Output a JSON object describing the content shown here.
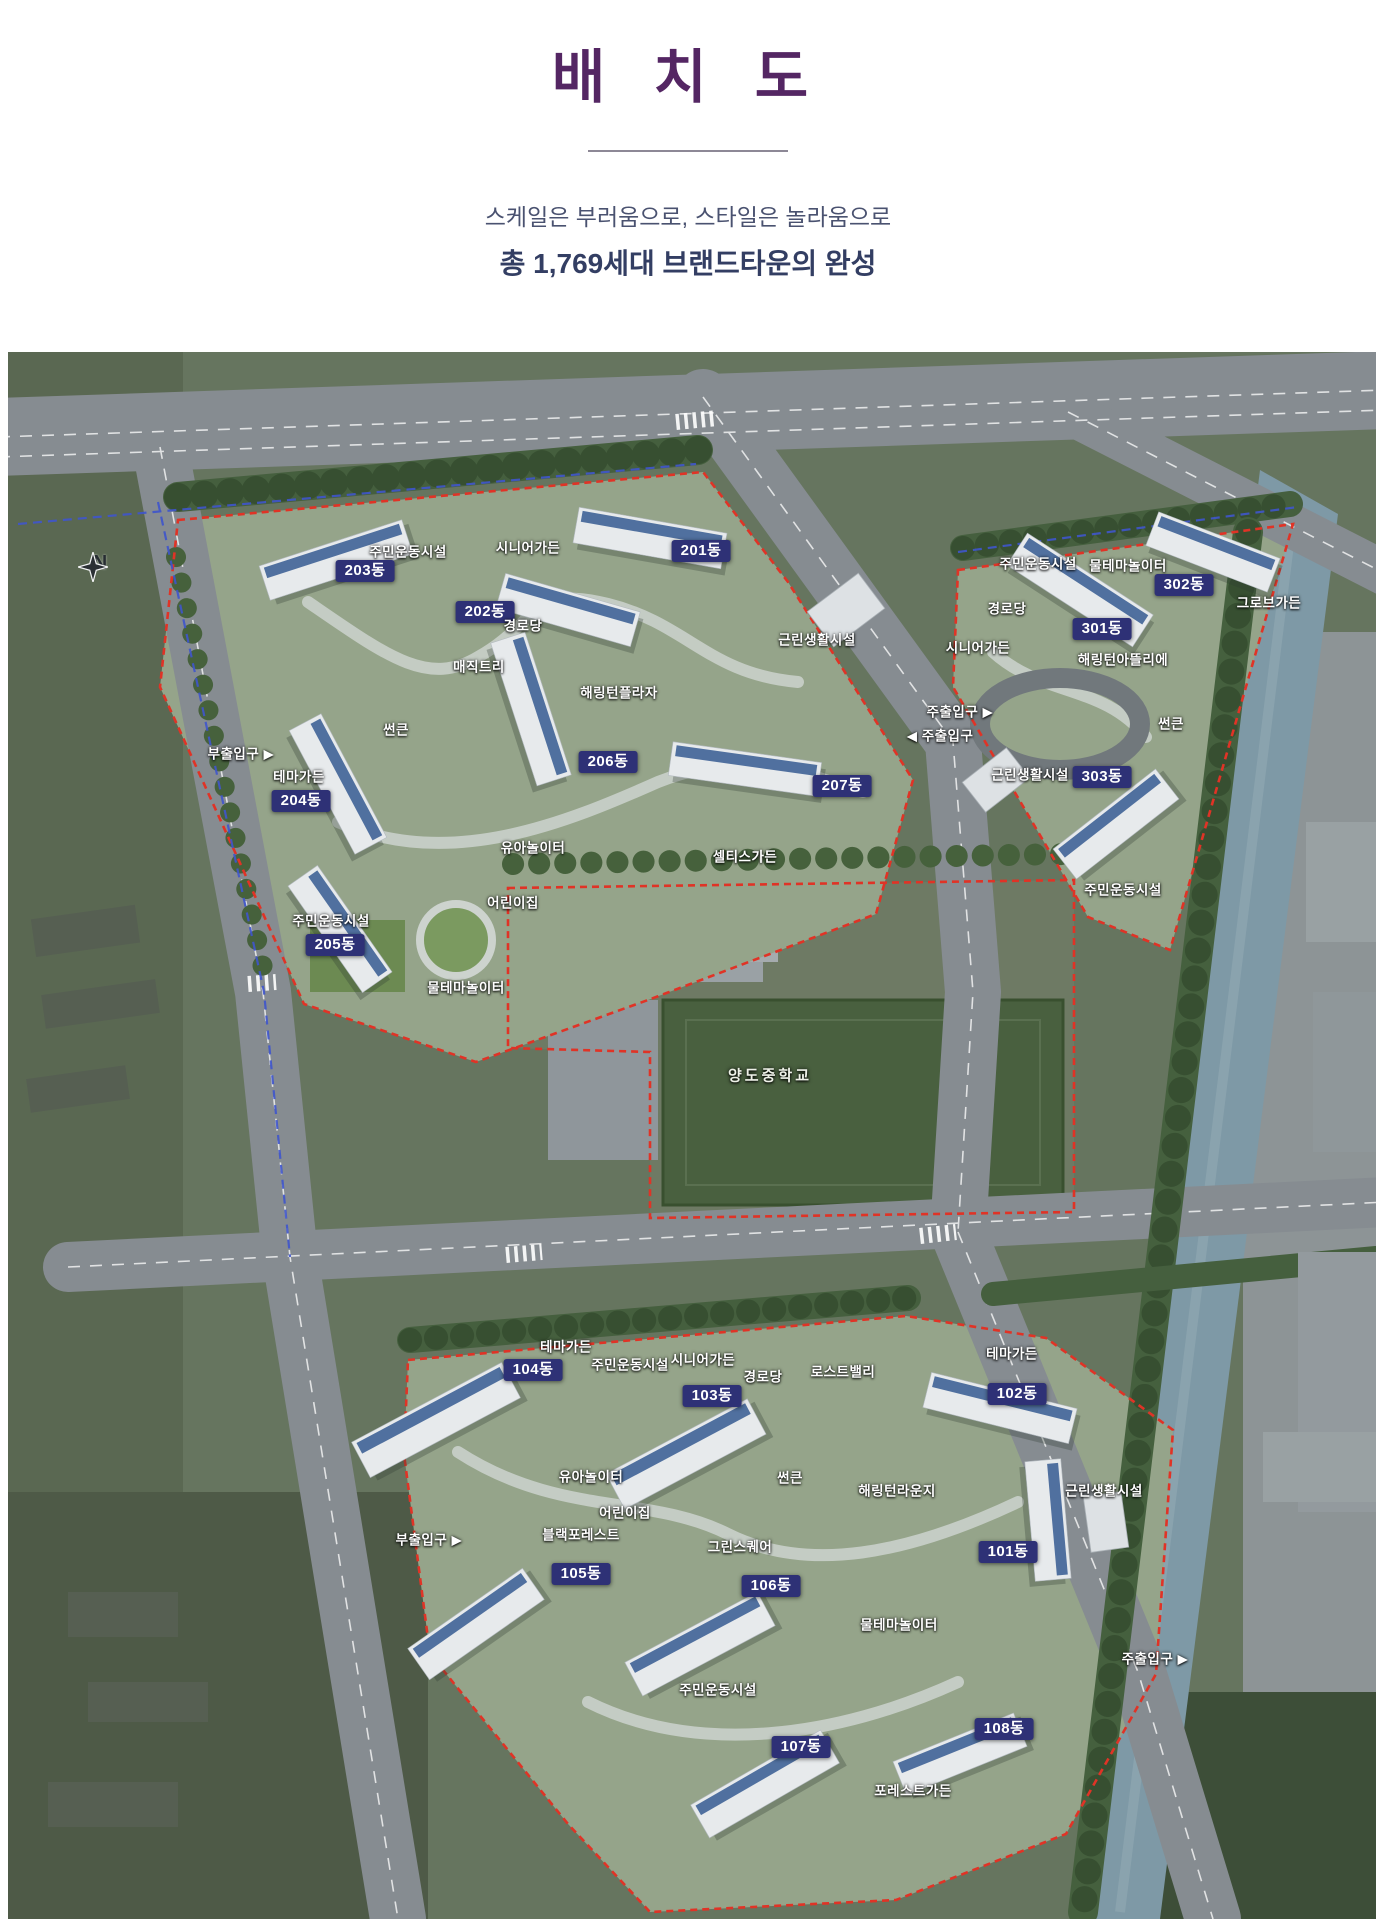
{
  "page": {
    "title": "배 치 도",
    "subtitle1": "스케일은 부러움으로, 스타일은 놀라움으로",
    "subtitle2": "총 1,769세대 브랜드타운의 완성"
  },
  "colors": {
    "title_purple": "#542663",
    "subtitle_navy": "#333e63",
    "dong_badge_navy": "#2e3176",
    "site_boundary_red": "#e03326",
    "road_boundary_blue": "#3f55cc"
  },
  "map": {
    "compass": "N",
    "labels": [
      {
        "text": "주민운동시설",
        "x": 400,
        "y": 200,
        "type": "place"
      },
      {
        "text": "203동",
        "x": 357,
        "y": 219,
        "type": "dong"
      },
      {
        "text": "시니어가든",
        "x": 520,
        "y": 196,
        "type": "place"
      },
      {
        "text": "201동",
        "x": 693,
        "y": 199,
        "type": "dong"
      },
      {
        "text": "202동",
        "x": 477,
        "y": 260,
        "type": "dong"
      },
      {
        "text": "경로당",
        "x": 515,
        "y": 274,
        "type": "place"
      },
      {
        "text": "매직트리",
        "x": 471,
        "y": 315,
        "type": "place"
      },
      {
        "text": "해링턴플라자",
        "x": 611,
        "y": 341,
        "type": "place"
      },
      {
        "text": "근린생활시설",
        "x": 809,
        "y": 288,
        "type": "place"
      },
      {
        "text": "썬큰",
        "x": 388,
        "y": 378,
        "type": "place"
      },
      {
        "text": "부출입구 ▶",
        "x": 233,
        "y": 402,
        "type": "entrance"
      },
      {
        "text": "테마가든",
        "x": 291,
        "y": 425,
        "type": "place"
      },
      {
        "text": "204동",
        "x": 293,
        "y": 449,
        "type": "dong"
      },
      {
        "text": "206동",
        "x": 600,
        "y": 410,
        "type": "dong"
      },
      {
        "text": "207동",
        "x": 834,
        "y": 434,
        "type": "dong"
      },
      {
        "text": "유아놀이터",
        "x": 525,
        "y": 496,
        "type": "place"
      },
      {
        "text": "셀티스가든",
        "x": 737,
        "y": 505,
        "type": "place"
      },
      {
        "text": "어린이집",
        "x": 505,
        "y": 551,
        "type": "place"
      },
      {
        "text": "주민운동시설",
        "x": 323,
        "y": 569,
        "type": "place"
      },
      {
        "text": "205동",
        "x": 327,
        "y": 593,
        "type": "dong"
      },
      {
        "text": "물테마놀이터",
        "x": 458,
        "y": 636,
        "type": "place"
      },
      {
        "text": "주민운동시설",
        "x": 1030,
        "y": 212,
        "type": "place"
      },
      {
        "text": "물테마놀이터",
        "x": 1120,
        "y": 214,
        "type": "place"
      },
      {
        "text": "302동",
        "x": 1176,
        "y": 233,
        "type": "dong"
      },
      {
        "text": "그로브가든",
        "x": 1261,
        "y": 251,
        "type": "place"
      },
      {
        "text": "경로당",
        "x": 999,
        "y": 257,
        "type": "place"
      },
      {
        "text": "301동",
        "x": 1094,
        "y": 277,
        "type": "dong"
      },
      {
        "text": "시니어가든",
        "x": 970,
        "y": 296,
        "type": "place"
      },
      {
        "text": "해링턴아뜰리에",
        "x": 1115,
        "y": 308,
        "type": "place"
      },
      {
        "text": "주출입구 ▶",
        "x": 952,
        "y": 360,
        "type": "entrance"
      },
      {
        "text": "◀ 주출입구",
        "x": 932,
        "y": 384,
        "type": "entrance"
      },
      {
        "text": "썬큰",
        "x": 1163,
        "y": 372,
        "type": "place"
      },
      {
        "text": "근린생활시설",
        "x": 1022,
        "y": 423,
        "type": "place"
      },
      {
        "text": "303동",
        "x": 1094,
        "y": 425,
        "type": "dong"
      },
      {
        "text": "주민운동시설",
        "x": 1115,
        "y": 538,
        "type": "place"
      },
      {
        "text": "양도중학교",
        "x": 762,
        "y": 724,
        "type": "school"
      },
      {
        "text": "테마가든",
        "x": 558,
        "y": 995,
        "type": "place"
      },
      {
        "text": "104동",
        "x": 525,
        "y": 1018,
        "type": "dong"
      },
      {
        "text": "주민운동시설",
        "x": 622,
        "y": 1013,
        "type": "place"
      },
      {
        "text": "시니어가든",
        "x": 695,
        "y": 1008,
        "type": "place"
      },
      {
        "text": "경로당",
        "x": 755,
        "y": 1025,
        "type": "place"
      },
      {
        "text": "로스트밸리",
        "x": 835,
        "y": 1020,
        "type": "place"
      },
      {
        "text": "103동",
        "x": 704,
        "y": 1044,
        "type": "dong"
      },
      {
        "text": "테마가든",
        "x": 1004,
        "y": 1002,
        "type": "place"
      },
      {
        "text": "102동",
        "x": 1009,
        "y": 1042,
        "type": "dong"
      },
      {
        "text": "유아놀이터",
        "x": 583,
        "y": 1125,
        "type": "place"
      },
      {
        "text": "썬큰",
        "x": 782,
        "y": 1126,
        "type": "place"
      },
      {
        "text": "어린이집",
        "x": 617,
        "y": 1161,
        "type": "place"
      },
      {
        "text": "해링턴라운지",
        "x": 889,
        "y": 1139,
        "type": "place"
      },
      {
        "text": "근린생활시설",
        "x": 1096,
        "y": 1139,
        "type": "place"
      },
      {
        "text": "부출입구 ▶",
        "x": 421,
        "y": 1188,
        "type": "entrance"
      },
      {
        "text": "블랙포레스트",
        "x": 573,
        "y": 1183,
        "type": "place"
      },
      {
        "text": "그린스퀘어",
        "x": 732,
        "y": 1195,
        "type": "place"
      },
      {
        "text": "105동",
        "x": 573,
        "y": 1222,
        "type": "dong"
      },
      {
        "text": "106동",
        "x": 763,
        "y": 1234,
        "type": "dong"
      },
      {
        "text": "101동",
        "x": 1000,
        "y": 1200,
        "type": "dong"
      },
      {
        "text": "물테마놀이터",
        "x": 891,
        "y": 1273,
        "type": "place"
      },
      {
        "text": "주출입구 ▶",
        "x": 1147,
        "y": 1307,
        "type": "entrance"
      },
      {
        "text": "주민운동시설",
        "x": 710,
        "y": 1338,
        "type": "place"
      },
      {
        "text": "107동",
        "x": 793,
        "y": 1395,
        "type": "dong"
      },
      {
        "text": "108동",
        "x": 996,
        "y": 1377,
        "type": "dong"
      },
      {
        "text": "포레스트가든",
        "x": 905,
        "y": 1439,
        "type": "place"
      }
    ]
  }
}
